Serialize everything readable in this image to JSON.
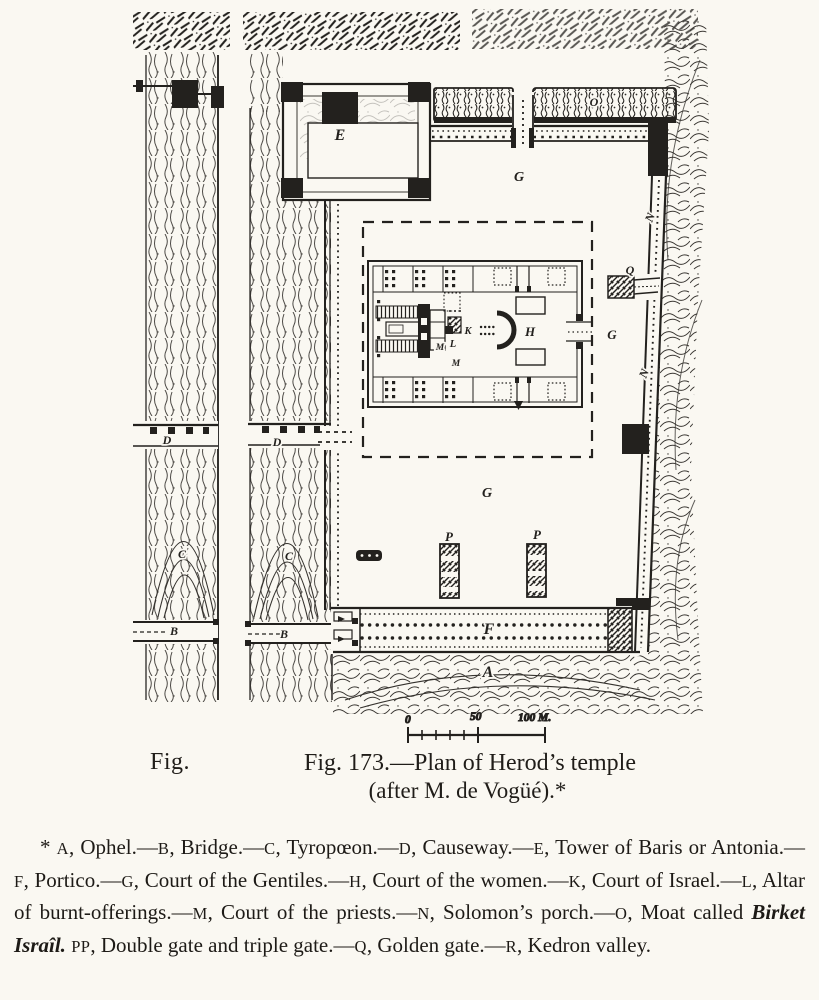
{
  "figure": {
    "fig_label_left": "Fig.",
    "caption_line1": "Fig. 173.—Plan of Herod’s temple",
    "caption_line2": "(after M. de Vogüé).*"
  },
  "plan": {
    "letters": [
      "E",
      "G",
      "O",
      "N",
      "Q",
      "G",
      "N",
      "H",
      "K",
      "L",
      "M",
      "M",
      "D",
      "D",
      "C",
      "C",
      "G",
      "P",
      "P",
      "B",
      "B",
      "F",
      "A"
    ]
  },
  "scale_bar": {
    "ticks": [
      "0",
      "50",
      "100 M."
    ]
  },
  "legend": {
    "lead": "* ",
    "items": [
      {
        "key": "A",
        "text": ", Ophel.",
        "sep": "—"
      },
      {
        "key": "B",
        "text": ", Bridge.",
        "sep": "—"
      },
      {
        "key": "C",
        "text": ", Tyropœon.",
        "sep": "—"
      },
      {
        "key": "D",
        "text": ", Causeway.",
        "sep": "—"
      },
      {
        "key": "E",
        "text": ", Tower of Baris or Antonia.",
        "sep": "—"
      },
      {
        "key": "F",
        "text": ", Portico.",
        "sep": "—"
      },
      {
        "key": "G",
        "text": ", Court of the Gentiles.",
        "sep": "—"
      },
      {
        "key": "H",
        "text": ", Court of the women.",
        "sep": "—"
      },
      {
        "key": "K",
        "text": ", Court of Israel.",
        "sep": "—"
      },
      {
        "key": "L",
        "text": ", Altar of burnt-offerings.",
        "sep": "—"
      },
      {
        "key": "M",
        "text": ", Court of the priests.",
        "sep": "—"
      },
      {
        "key": "N",
        "text": ", Solomon’s porch.",
        "sep": "—"
      },
      {
        "key": "O",
        "text": ", Moat called ",
        "italic": "Birket Israîl.",
        "sep": " "
      },
      {
        "key": "PP",
        "text": ", Double gate and triple gate.",
        "sep": "—"
      },
      {
        "key": "Q",
        "text": ", Golden gate.",
        "sep": "—"
      },
      {
        "key": "R",
        "text": ", Kedron valley.",
        "sep": ""
      }
    ]
  }
}
